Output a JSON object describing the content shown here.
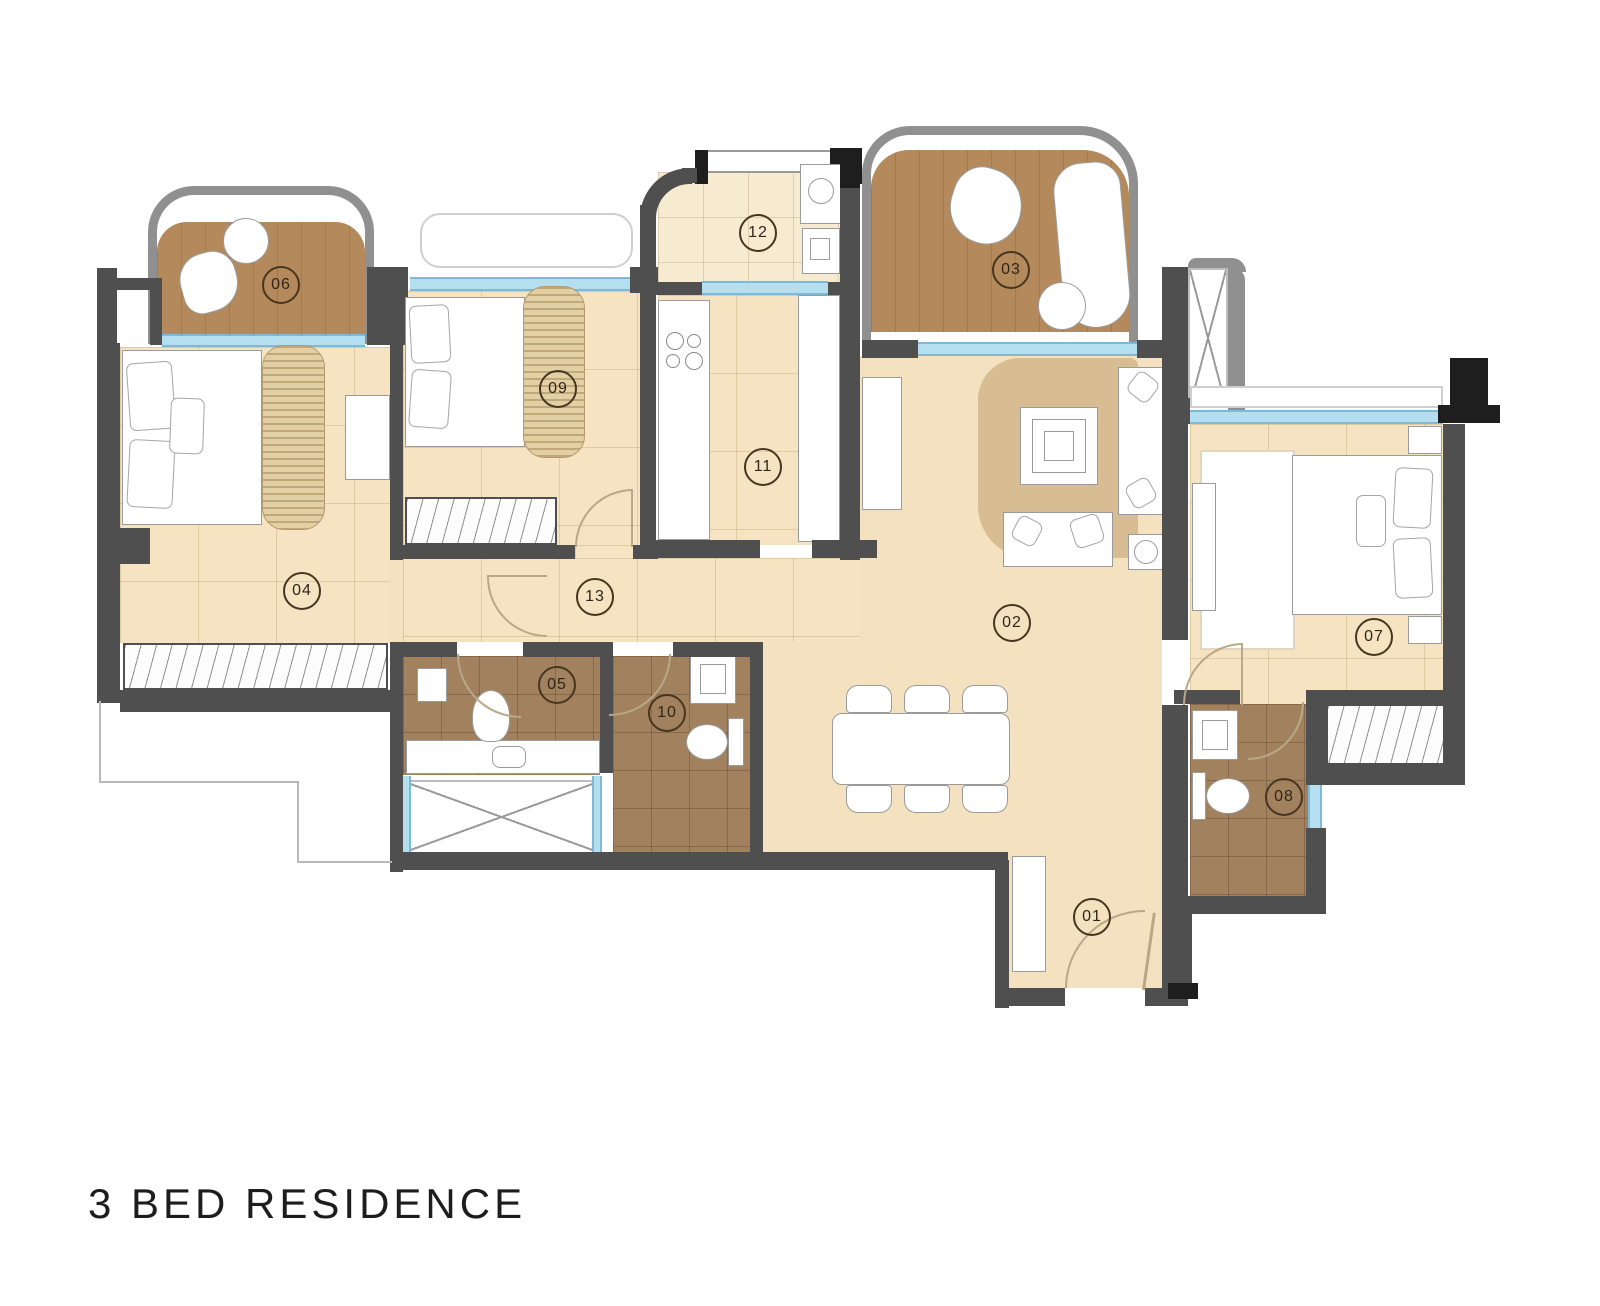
{
  "title": "3 BED RESIDENCE",
  "rooms": [
    {
      "label": "01"
    },
    {
      "label": "02"
    },
    {
      "label": "03"
    },
    {
      "label": "04"
    },
    {
      "label": "05"
    },
    {
      "label": "06"
    },
    {
      "label": "07"
    },
    {
      "label": "08"
    },
    {
      "label": "09"
    },
    {
      "label": "10"
    },
    {
      "label": "11"
    },
    {
      "label": "12"
    },
    {
      "label": "13"
    }
  ],
  "colors": {
    "wall": "#4f4f4f",
    "wall_accent": "#1e1e1e",
    "parapet": "#909090",
    "wood_deck": "#b4895c",
    "tile_beige": "#f5e3c1",
    "tile_bath": "#a2815f",
    "tile_utility": "#f6ebd1",
    "window_glass": "#b4dff1",
    "rug": "#d8bd92",
    "door_swing": "#b9a888",
    "label_ring": "#46361f"
  }
}
